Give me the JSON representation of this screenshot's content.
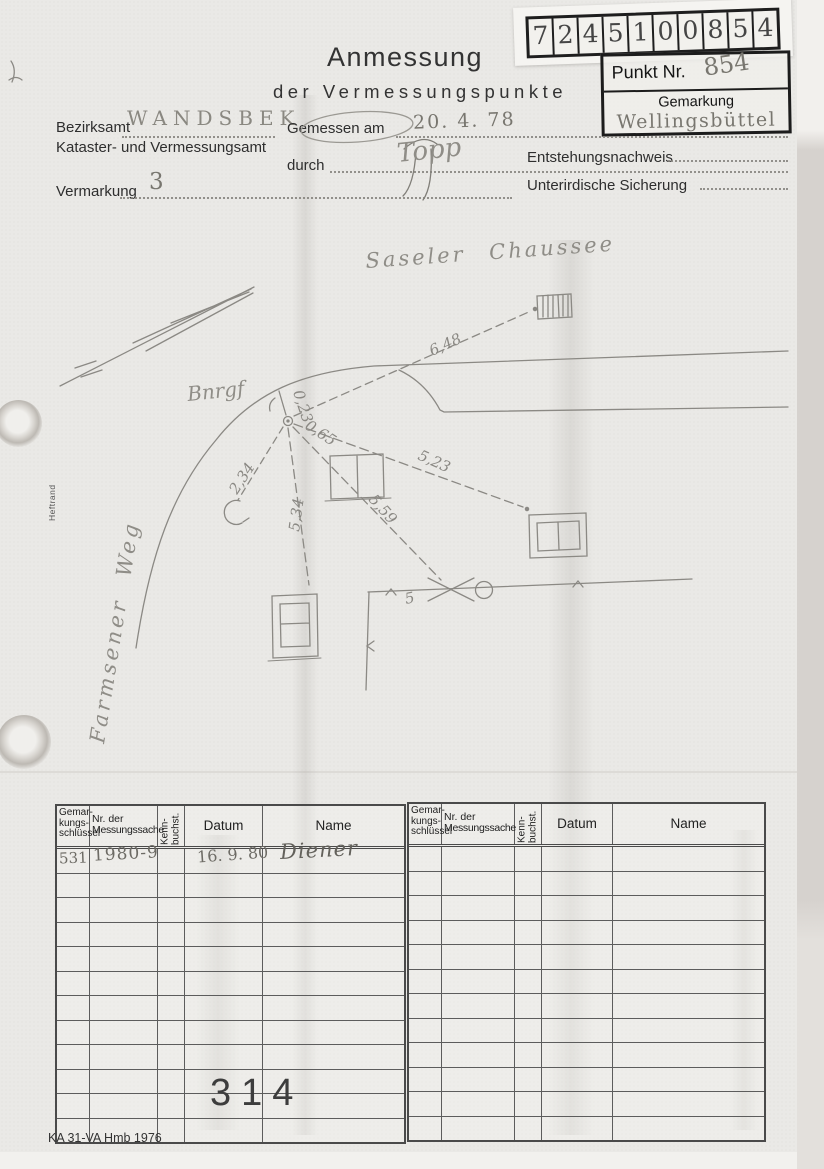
{
  "scan": {
    "stamp_digits": [
      "7",
      "2",
      "4",
      "5",
      "1",
      "0",
      "0",
      "8",
      "5",
      "4"
    ]
  },
  "header": {
    "title_line1": "Anmessung",
    "title_line2": "der Vermessungspunkte",
    "punkt_label": "Punkt Nr.",
    "punkt_value": "854",
    "gemarkung_label": "Gemarkung",
    "gemarkung_value": "Wellingsbüttel",
    "bezirksamt_label": "Bezirksamt",
    "bezirksamt_value": "WANDSBEK",
    "kataster_label": "Kataster- und Vermessungsamt",
    "gemessen_label": "Gemessen am",
    "gemessen_value": "20. 4. 78",
    "durch_label": "durch",
    "durch_value": "Topp",
    "vermarkung_label": "Vermarkung",
    "vermarkung_value": "3",
    "entstehung_label": "Entstehungsnachweis",
    "sicherung_label": "Unterirdische Sicherung"
  },
  "sketch": {
    "street_top": "Saseler Chaussee",
    "street_left": "Farmsener Weg",
    "point_label": "Bnrgf",
    "margin_label": "Heftrand",
    "m_023": "0,23",
    "m_065": "0,65",
    "m_234": "2,34",
    "m_534": "5,34",
    "m_559": "5,59",
    "m_523": "5,23",
    "m_648": "6,48",
    "m_5": "5"
  },
  "table": {
    "header": {
      "col1_l1": "Gemar-",
      "col1_l2": "kungs-",
      "col1_l3": "schlüssel",
      "col2_l1": "Nr. der",
      "col2_l2": "Messungssache",
      "col3_l1": "Kenn-",
      "col3_l2": "buchst.",
      "col4": "Datum",
      "col5": "Name"
    },
    "row1": {
      "schluessel": "531",
      "messungssache": "1980-9",
      "datum": "16. 9. 80",
      "name": "Diener"
    },
    "stamp": "314"
  },
  "footer": {
    "form_code": "KA 31-VA Hmb 1976"
  }
}
